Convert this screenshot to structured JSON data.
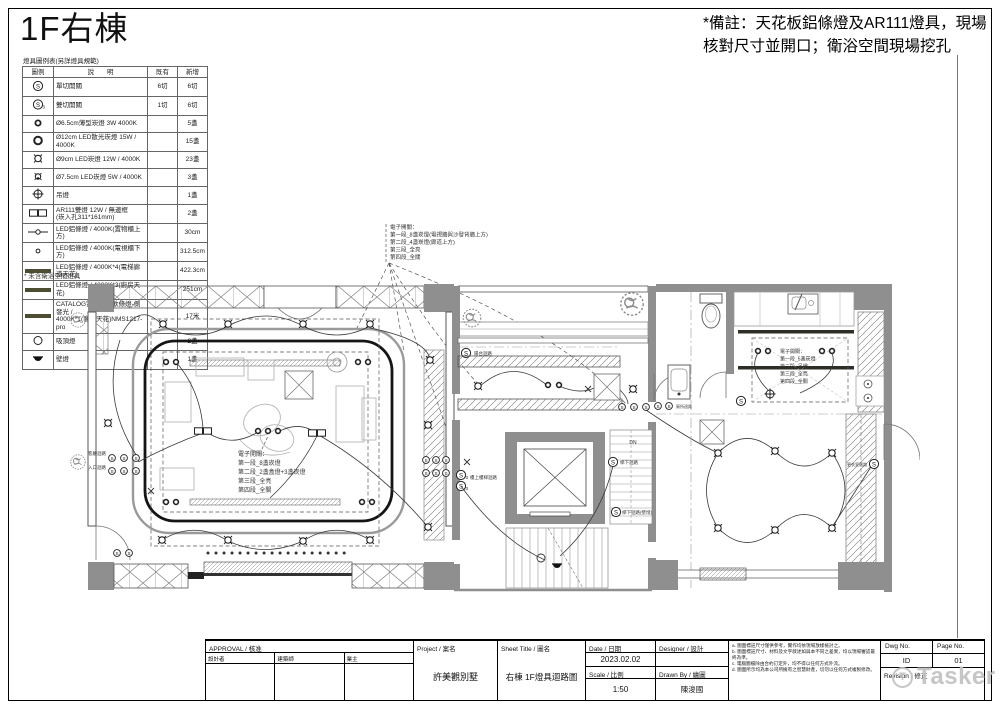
{
  "sheet": {
    "title": "1F右棟",
    "legend_caption": "燈具圖例表(另詳燈具規範)",
    "note_line1": "*備註：天花板鋁條燈及AR111燈具，現場",
    "note_line2": "核對尺寸並開口；衛浴空間現場挖孔",
    "footnote": "*  未含衛浴空間燈具"
  },
  "colors": {
    "wall_gray": "#8f8f8f",
    "strip_olive": "#4d4d33",
    "watermark_gray": "#c3c3c3"
  },
  "legend": {
    "h": {
      "sym": "圖例",
      "desc": "說　　明",
      "exist": "既有",
      "add": "新增"
    },
    "rows": [
      {
        "d": "單切開關",
        "e": "6切",
        "n": "6切"
      },
      {
        "d": "雙切開關",
        "e": "1切",
        "n": "6切"
      },
      {
        "d": "Ø6.5cm薄型崁燈 3W 4000K",
        "e": "",
        "n": "5盞"
      },
      {
        "d": "Ø12cm LED散光崁燈 15W / 4000K",
        "e": "",
        "n": "15盞"
      },
      {
        "d": "Ø9cm LED崁燈 12W / 4000K",
        "e": "",
        "n": "23盞"
      },
      {
        "d": "Ø7.5cm LED崁燈 5W / 4000K",
        "e": "",
        "n": "3盞"
      },
      {
        "d": "吊燈",
        "e": "",
        "n": "1盞"
      },
      {
        "d": "AR111雙燈 12W / 無邊框",
        "d2": "(崁入孔311*161mm)",
        "e": "",
        "n": "2盞"
      },
      {
        "d": "LED鋁條燈 / 4000K(置物櫃上方)",
        "e": "",
        "n": "30cm"
      },
      {
        "d": "LED鋁條燈 / 4000K(電視櫃下方)",
        "e": "",
        "n": "312.5cm"
      },
      {
        "d": "LED鋁條燈 / 4000K*4(電梯廊道天花)",
        "e": "",
        "n": "422.3cm"
      },
      {
        "d": "LED鋁條燈 / 4000K*3(廚房天花)",
        "e": "",
        "n": "251cm"
      },
      {
        "d": "CATALOG霓虹系列軟條燈-側發光 /",
        "d2": "4000K*1(客廳天花)NMS1217-pro",
        "e": "",
        "n": "17米"
      },
      {
        "d": "吸頂燈",
        "e": "",
        "n": "2盞"
      },
      {
        "d": "壁燈",
        "e": "",
        "n": "1盞"
      }
    ]
  },
  "plan": {
    "sw": "S",
    "sw3": "3",
    "dn": "DN",
    "ann_top": [
      "電子開關：",
      "第一段_8盞崁燈(電視牆與沙發背牆上方)",
      "第二段_4盞崁燈(廊道上方)",
      "第三段_全亮",
      "第四段_全關"
    ],
    "ann_living": [
      "電子開關：",
      "第一段_8盞崁燈",
      "第二段_2盞盒燈+3盞崁燈",
      "第三段_全亮",
      "第四段_全關"
    ],
    "ann_kitchen": [
      "電子開關：",
      "第一段_5盞崁燈",
      "第二段_吊燈",
      "第三段_全亮",
      "第四段_全關"
    ],
    "lbl": {
      "balcony": "陽台迴路",
      "living": "客廳迴路",
      "entry": "入口迴路",
      "bath": "廁所迴路",
      "stair_up": "樓上樓梯迴路",
      "stair_dn": "梯下迴路",
      "stair_dn2": "梯下迴路(壁燈)",
      "closet": "更衣室迴路"
    }
  },
  "titleblock": {
    "approval_label": "APPROVAL / 核准",
    "approval_cols": [
      "設計者",
      "建築師",
      "業主"
    ],
    "project_label": "Project / 案名",
    "project_value": "許美觀別墅",
    "sheet_label": "Sheet Title / 圖名",
    "sheet_value": "右棟 1F燈具迴路圖",
    "date_label": "Date / 日期",
    "date_value": "2023.02.02",
    "scale_label": "Scale / 比例",
    "scale_value": "1:50",
    "designer_label": "Designer / 設計",
    "designer_value": "",
    "drawnby_label": "Drawn By / 繪圖",
    "drawnby_value": "陳浚國",
    "notes": [
      "a. 圖面標註尺寸僅供參考，實作均依現場放樣檢討之。",
      "b. 圖面標註尺寸、材料及文字敘述如與本不同之差異，均以現場審認最終為準。",
      "c. 電腦圖檔除由合約訂定外，均不得以任何方式外流。",
      "d. 圖面所示均為本公司所擁有之智慧財產，切勿以任何方式複製修改。"
    ],
    "dwg_label": "Dwg No.",
    "dwg_value": "ID",
    "page_label": "Page No.",
    "page_value": "01",
    "revision_label": "Revision / 修正",
    "watermark_circle": "T",
    "watermark": "Tasker"
  }
}
